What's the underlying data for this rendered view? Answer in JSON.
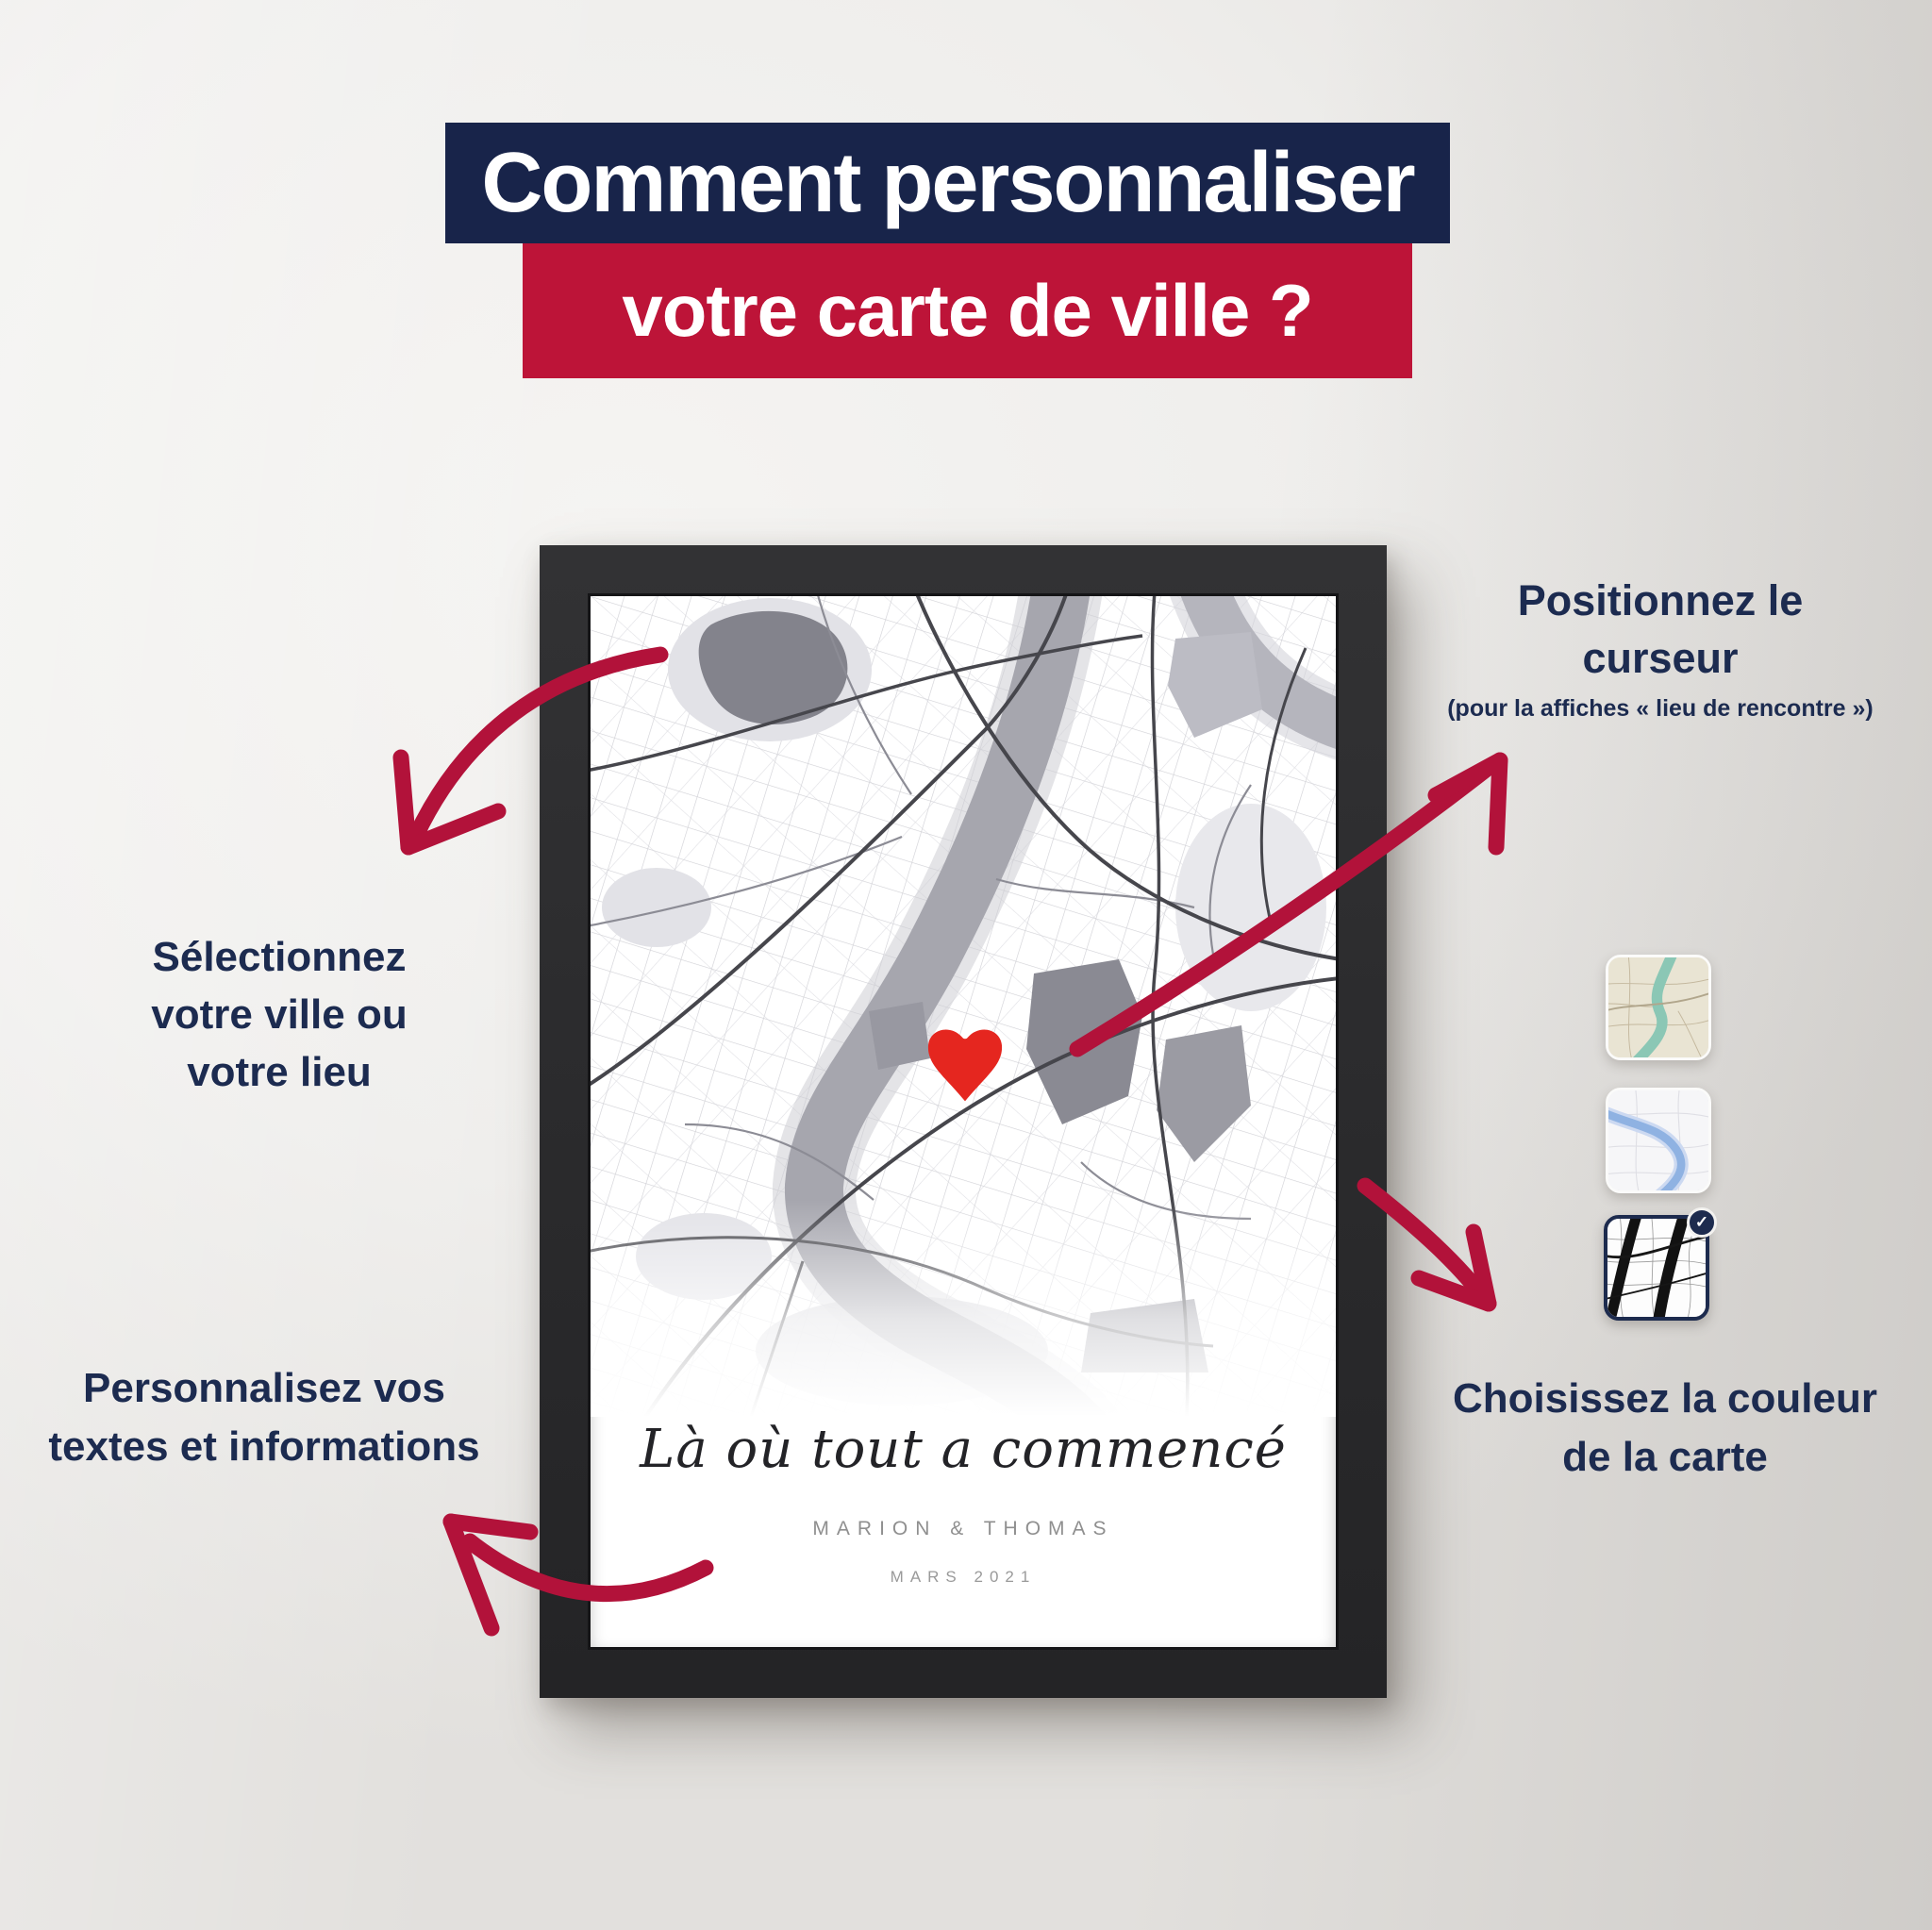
{
  "title": {
    "line1": "Comment personnaliser",
    "line2": "votre carte de ville ?"
  },
  "annotations": {
    "select_city": {
      "line1": "Sélectionnez",
      "line2": "votre ville ou",
      "line3": "votre lieu"
    },
    "position_cursor": {
      "line1": "Positionnez le",
      "line2": "curseur",
      "note": "(pour la affiches « lieu de rencontre »)"
    },
    "personalize": {
      "line1": "Personnalisez vos",
      "line2": "textes et informations"
    },
    "choose_color": {
      "line1": "Choisissez la couleur",
      "line2": "de la carte"
    }
  },
  "poster": {
    "script_title": "Là où tout a commencé",
    "names": "MARION & THOMAS",
    "date": "MARS 2021"
  },
  "map_styles": [
    {
      "id": "vintage",
      "selected": false
    },
    {
      "id": "light-blue",
      "selected": false
    },
    {
      "id": "black-white",
      "selected": true
    }
  ],
  "icons": {
    "check": "✓",
    "heart": "heart-map-marker"
  },
  "colors": {
    "navy_band": "#18244a",
    "red_band": "#bd1438",
    "arrow_red": "#b2123a",
    "heart_red": "#e5261f",
    "text_navy": "#1c2b50",
    "frame": "#2b2b2d",
    "caption_gray": "#8f8f8f"
  }
}
